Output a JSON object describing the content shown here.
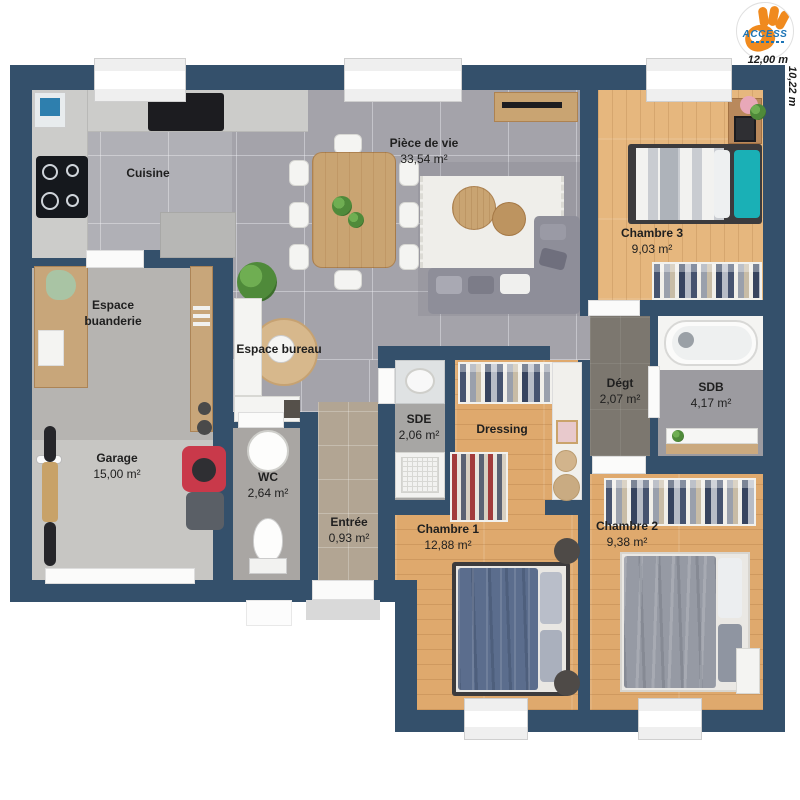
{
  "branding": {
    "logo_text": "ACCESS"
  },
  "dimensions": {
    "width_label": "12,00 m",
    "height_label": "10,22 m"
  },
  "rooms": [
    {
      "id": "cuisine",
      "name": "Cuisine",
      "area": ""
    },
    {
      "id": "piece_de_vie",
      "name": "Pièce de vie",
      "area": "33,54 m²"
    },
    {
      "id": "chambre3",
      "name": "Chambre 3",
      "area": "9,03 m²"
    },
    {
      "id": "buanderie",
      "name": "Espace buanderie",
      "area": ""
    },
    {
      "id": "bureau",
      "name": "Espace bureau",
      "area": ""
    },
    {
      "id": "garage",
      "name": "Garage",
      "area": "15,00 m²"
    },
    {
      "id": "wc",
      "name": "WC",
      "area": "2,64 m²"
    },
    {
      "id": "entree",
      "name": "Entrée",
      "area": "0,93 m²"
    },
    {
      "id": "sde",
      "name": "SDE",
      "area": "2,06 m²"
    },
    {
      "id": "dressing",
      "name": "Dressing",
      "area": ""
    },
    {
      "id": "chambre1",
      "name": "Chambre 1",
      "area": "12,88 m²"
    },
    {
      "id": "degt",
      "name": "Dégt",
      "area": "2,07 m²"
    },
    {
      "id": "sdb",
      "name": "SDB",
      "area": "4,17 m²"
    },
    {
      "id": "chambre2",
      "name": "Chambre 2",
      "area": "9,38 m²"
    }
  ],
  "colors": {
    "wall": "#34506b",
    "floor_tile": "#a4a3aa",
    "floor_wood": "#dfa96d",
    "floor_wood_light": "#e6b77e",
    "floor_concrete": "#c7c6c3",
    "floor_laundry": "#b6b4b1",
    "floor_beige": "#b2a593",
    "floor_dark": "#7c776f",
    "floor_bath": "#9c9ba0",
    "floor_wc": "#a9a6a3",
    "accent_teal": "#1ab0b6",
    "blanket_blue": "#5b6d8d",
    "blanket_gray": "#969aa4",
    "mower_red": "#c9394a",
    "logo_orange": "#f08a1e",
    "logo_blue": "#1c74b6",
    "label_text": "#1f1f1f"
  }
}
